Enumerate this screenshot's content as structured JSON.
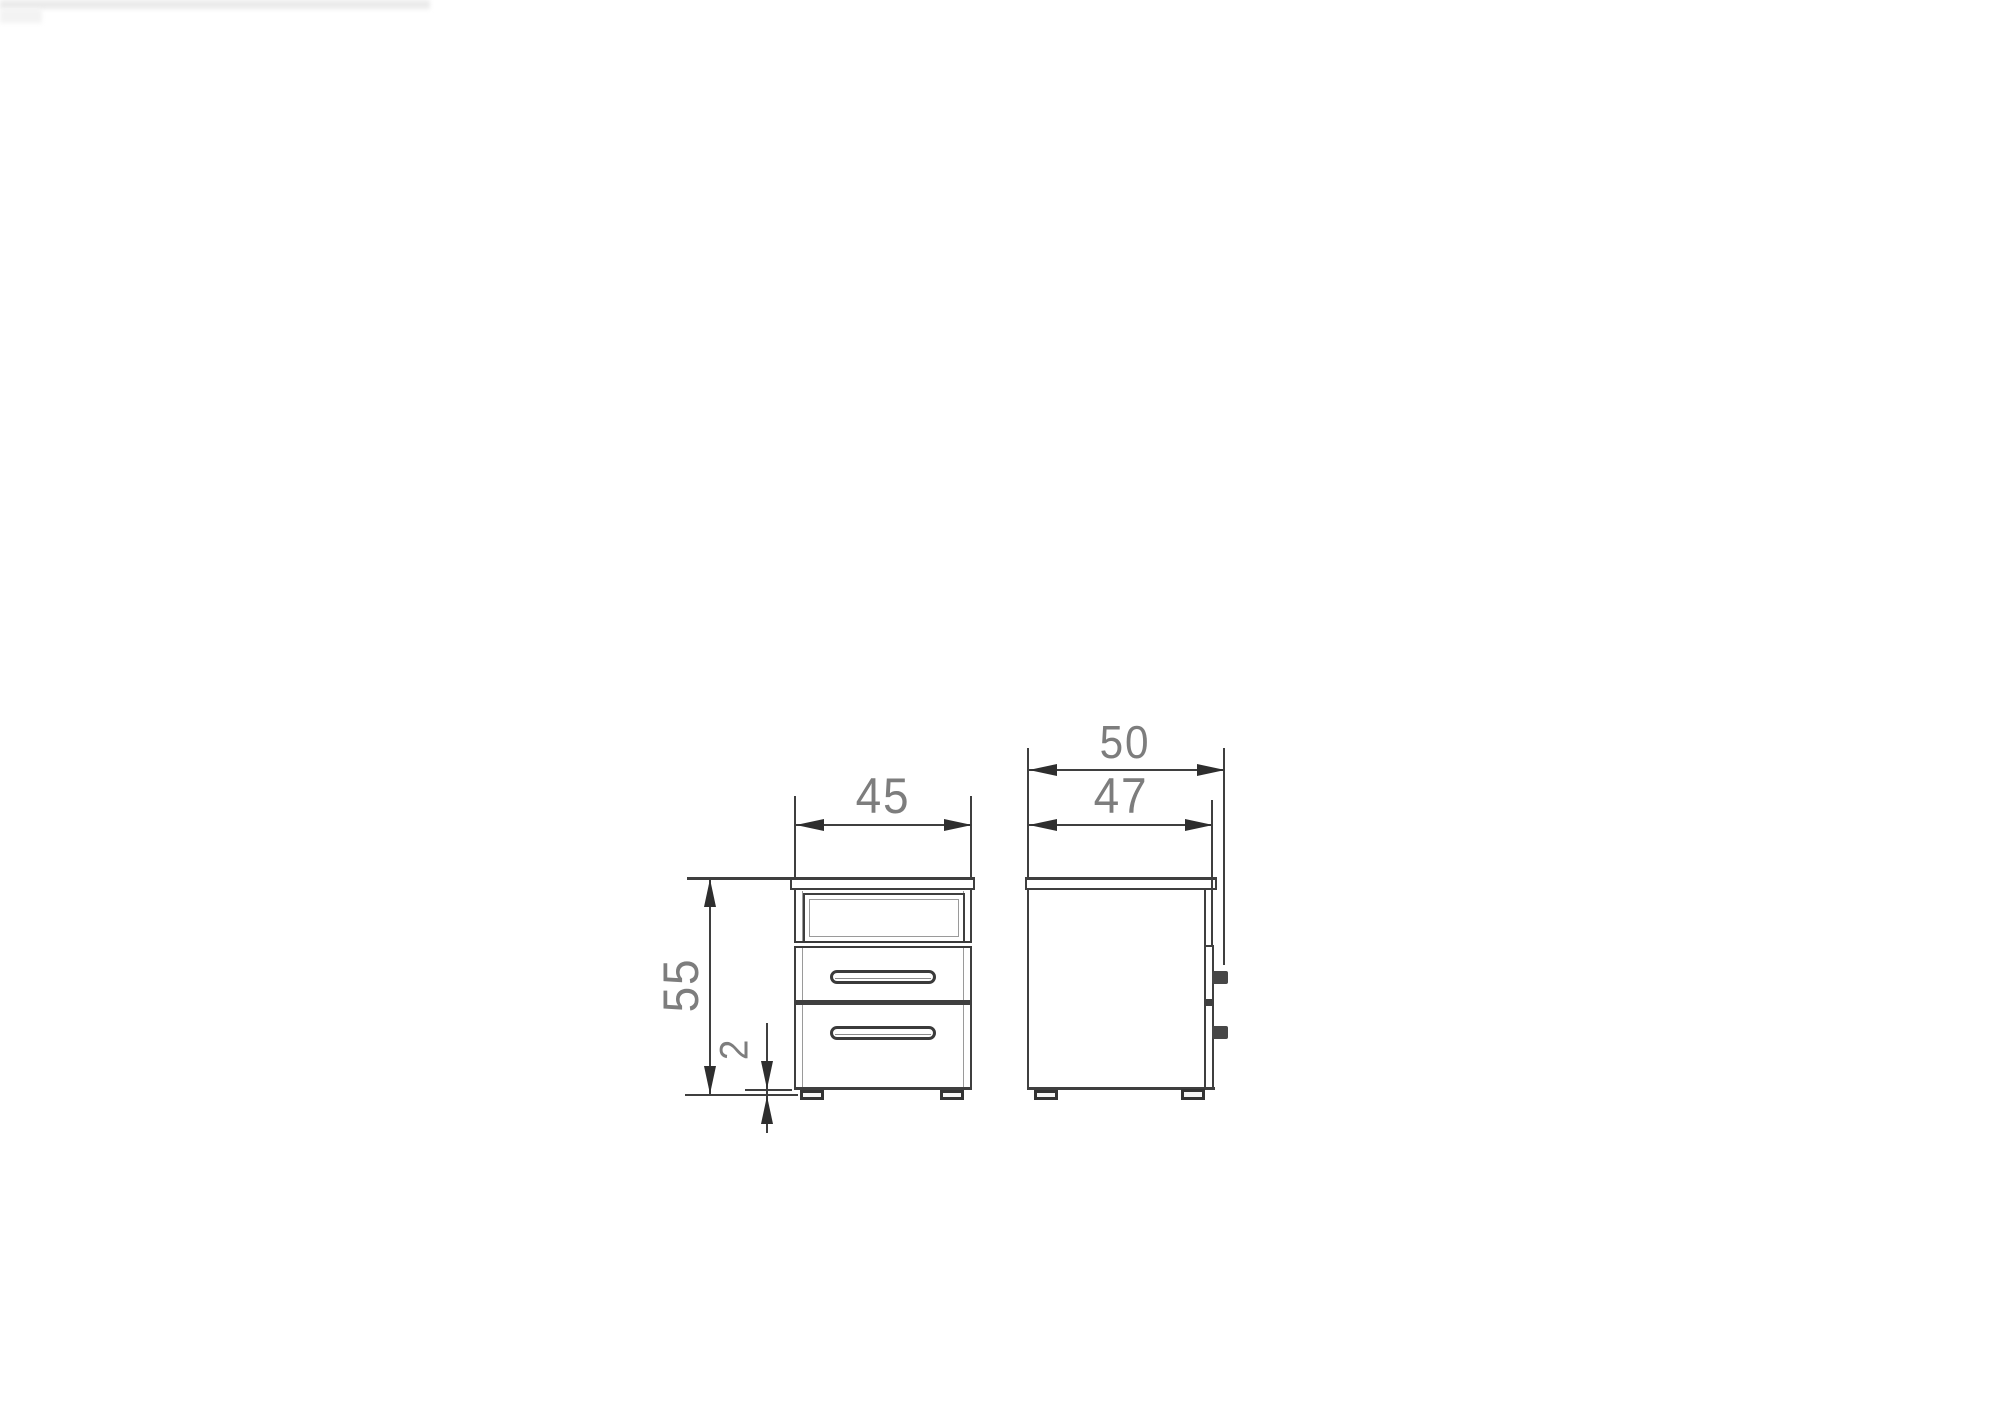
{
  "diagram": {
    "type": "furniture-technical-drawing",
    "subject": "two-drawer bedside cabinet, front and side elevation",
    "views": {
      "front": {
        "dims": {
          "width": {
            "label": "45",
            "orientation": "horizontal"
          },
          "height": {
            "label": "55",
            "orientation": "vertical"
          },
          "foot_height": {
            "label": "2",
            "orientation": "vertical"
          }
        }
      },
      "side": {
        "dims": {
          "overall_depth": {
            "label": "50",
            "orientation": "horizontal"
          },
          "body_depth": {
            "label": "47",
            "orientation": "horizontal"
          }
        }
      }
    },
    "colors": {
      "line": "#3f3f3f",
      "thin_line": "#9a9a9a",
      "dim_text": "#7d7d7d",
      "background": "#ffffff"
    }
  }
}
